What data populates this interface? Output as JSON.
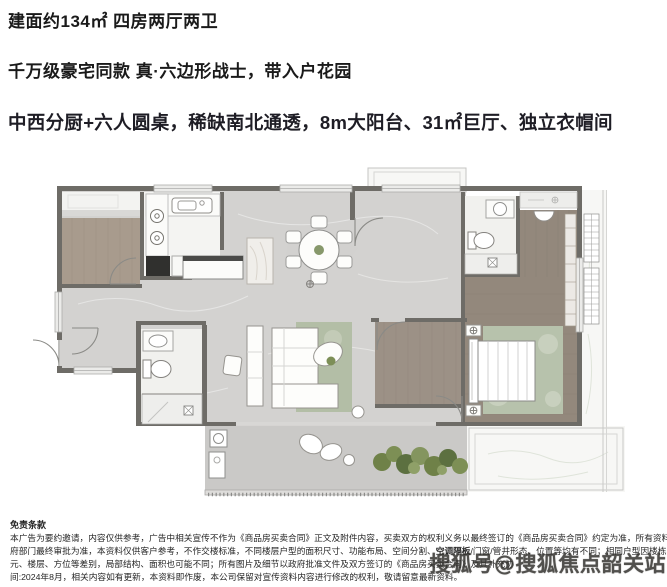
{
  "headlines": {
    "line1": "建面约134㎡ 四房两厅两卫",
    "line2": "千万级豪宅同款 真·六边形战士，带入户花园",
    "line3": "中西分厨+六人圆桌，稀缺南北通透，8m大阳台、31㎡巨厅、独立衣帽间"
  },
  "disclaimer": {
    "title": "免责条款",
    "line1": "本广告为要约邀请，内容仅供参考，广告中相关宣传不作为《商品房买卖合同》正文及附件内容，买卖双方的权利义务以最终签订的《商品房买卖合同》约定为准，所有资料以政",
    "line2_pre": "府部门最终审批为准，本资料仅供客户参考，不作交楼标准，不同楼层户型的面积尺寸、功能布局、空间分割、",
    "line2_bold": "空调隔板",
    "line2_post": "/门窗/管井形态、位置等均有不同；相同户型因楼栋、单",
    "line3": "元、楼层、方位等差别，局部结构、面积也可能不同；所有图片及细节以政府批准文件及双方签订的《商品房买卖合同》及其补充协",
    "line4": "间:2024年8月，相关内容如有更新，本资料即作废，本公司保留对宣传资料内容进行修改的权利，敬请留意最新资料。"
  },
  "watermark": {
    "text": "搜狐号@搜狐焦点韶关站"
  },
  "colors": {
    "headline_text": "#1a1a1a",
    "wall": "#6e6c67",
    "floor_marble": "#d3d2d0",
    "room_white": "#f3f3f1",
    "wood_floor_study": "#a89b8d",
    "wood_floor_master": "#93887c",
    "wood_floor_bedroom3": "#9c9186",
    "rug_green": "#b5c0a8",
    "plant_green": "#6f8148",
    "balcony_floor": "#cac9c7",
    "terrace_white": "#f7f7f5",
    "watermark_text": "#33322f"
  }
}
